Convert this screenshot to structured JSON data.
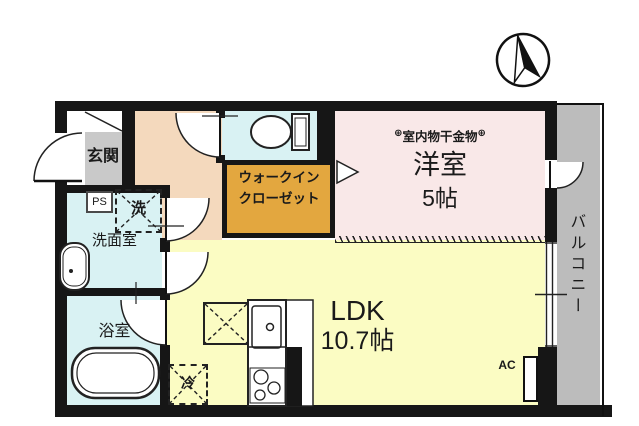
{
  "title": "間取り図",
  "colors": {
    "wall": "#161616",
    "entrance": "#c9c9c9",
    "hallway": "#f4d9bd",
    "water_rooms": "#d9f2f3",
    "closet": "#e3a73f",
    "bedroom": "#f9e8e8",
    "ldk": "#fbfcc3",
    "balcony": "#bcbcbc"
  },
  "compass": {
    "type": "north-arrow"
  },
  "rooms": {
    "entrance": {
      "label": "玄関"
    },
    "pipe_space": {
      "label": "PS"
    },
    "washer": {
      "label": "洗"
    },
    "washroom": {
      "label": "洗面室"
    },
    "bathroom": {
      "label": "浴室"
    },
    "walk_in_closet": {
      "label_line1": "ウォークイン",
      "label_line2": "クローゼット"
    },
    "western_room": {
      "hardware_symbol": "⊕",
      "hardware_note": "室内物干金物",
      "label": "洋室",
      "size": "5帖"
    },
    "ldk": {
      "label": "LDK",
      "size": "10.7帖"
    },
    "refrigerator": {
      "label": "冷"
    },
    "air_conditioner": {
      "label": "AC"
    },
    "balcony": {
      "label": "バルコニー"
    }
  }
}
